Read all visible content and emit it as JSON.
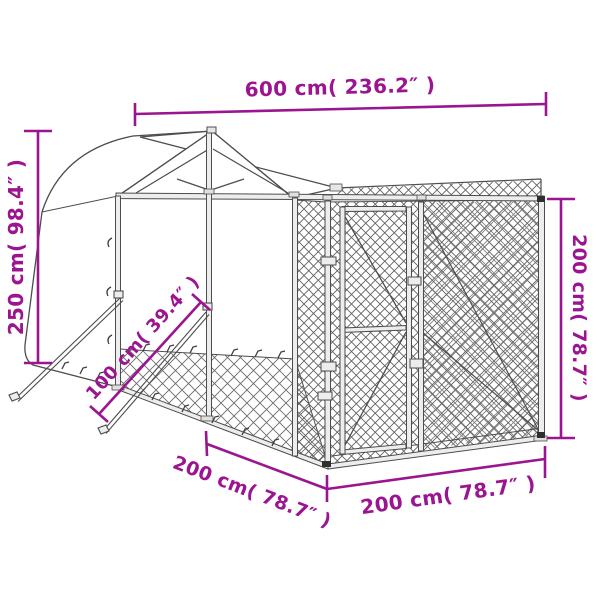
{
  "page": {
    "background": "#ffffff"
  },
  "diagram": {
    "type": "product-dimension-drawing",
    "subject": "outdoor dog kennel with gabled canopy roof, chain-link mesh walls, door and ground support struts",
    "annotation_color": "#9B1490",
    "line_color": "#4d4d4d",
    "labels": {
      "length_top": "600 cm( 236.2″ )",
      "height_left": "250 cm( 98.4″ )",
      "height_right": "200 cm( 78.7″ )",
      "strut_diagonal": "100 cm( 39.4″ )",
      "depth_bottom_left": "200 cm( 78.7″ )",
      "width_bottom_right": "200 cm( 78.7″ )"
    }
  }
}
